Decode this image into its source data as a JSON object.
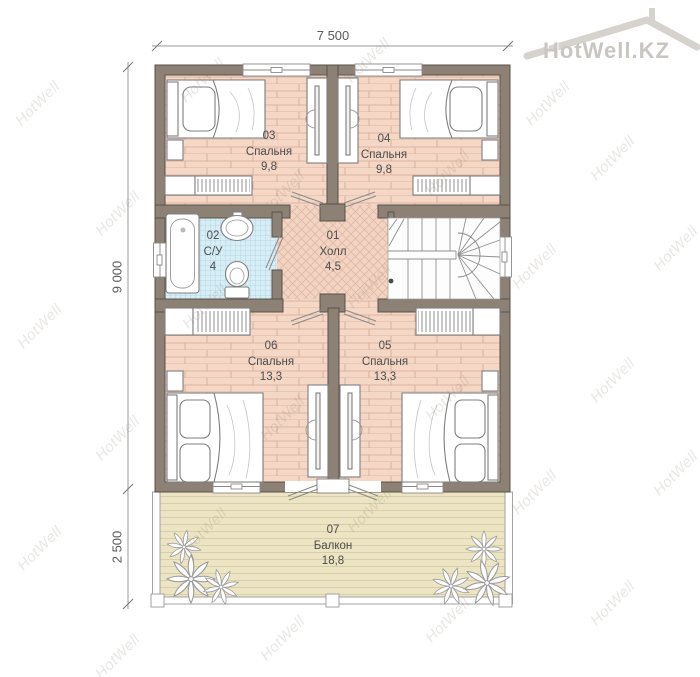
{
  "logo": {
    "text": "HotWell.KZ"
  },
  "watermark": {
    "text": "HotWell",
    "tiles": [
      [
        10,
        95
      ],
      [
        175,
        72
      ],
      [
        340,
        52
      ],
      [
        520,
        95
      ],
      [
        90,
        205
      ],
      [
        255,
        185
      ],
      [
        420,
        165
      ],
      [
        585,
        150
      ],
      [
        12,
        318
      ],
      [
        177,
        298
      ],
      [
        342,
        278
      ],
      [
        507,
        258
      ],
      [
        648,
        240
      ],
      [
        90,
        430
      ],
      [
        255,
        410
      ],
      [
        420,
        390
      ],
      [
        585,
        372
      ],
      [
        12,
        540
      ],
      [
        177,
        522
      ],
      [
        342,
        502
      ],
      [
        507,
        484
      ],
      [
        648,
        465
      ],
      [
        90,
        648
      ],
      [
        255,
        630
      ],
      [
        420,
        612
      ],
      [
        585,
        595
      ]
    ]
  },
  "dimensions": {
    "width": "7 500",
    "height": "9 000",
    "balcony_depth": "2 500"
  },
  "rooms": [
    {
      "id": "01",
      "name": "Холл",
      "area": "4,5"
    },
    {
      "id": "02",
      "name": "С/У",
      "area": "4"
    },
    {
      "id": "03",
      "name": "Спальня",
      "area": "9,8"
    },
    {
      "id": "04",
      "name": "Спальня",
      "area": "9,8"
    },
    {
      "id": "05",
      "name": "Спальня",
      "area": "13,3"
    },
    {
      "id": "06",
      "name": "Спальня",
      "area": "13,3"
    },
    {
      "id": "07",
      "name": "Балкон",
      "area": "18,8"
    }
  ],
  "colors": {
    "wall": "#8c8174",
    "bedroom_floor": "#f5d7c5",
    "hall_floor": "#f4d5c3",
    "bathroom_floor": "#d8eef6",
    "balcony_floor": "#ece4c2",
    "watermark": "#8a7f70"
  }
}
